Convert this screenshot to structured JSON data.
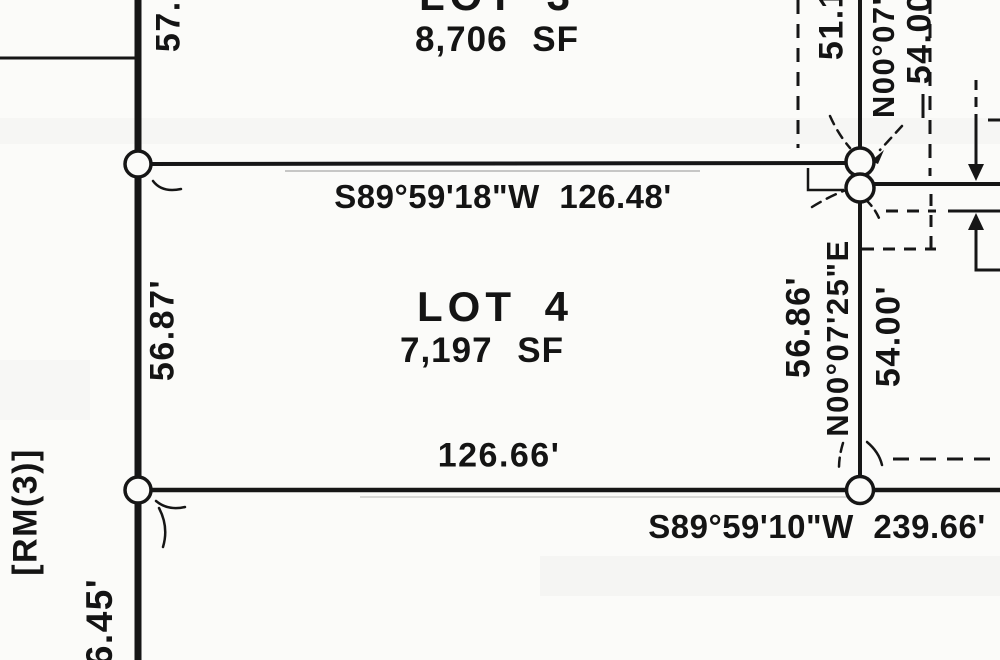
{
  "page": {
    "background": "#fbfbf9",
    "ink": "#141414"
  },
  "lots": {
    "lot3": {
      "name": "LOT 3",
      "area": "8,706 SF"
    },
    "lot4": {
      "name": "LOT 4",
      "area": "7,197 SF"
    }
  },
  "dimensions": {
    "north_bearing": "S89°59'18\"W 126.48'",
    "south_segment": "126.66'",
    "south_bearing": "S89°59'10\"W 239.66'",
    "west_top_partial": "57.0",
    "west_mid": "56.87'",
    "west_reference": "[RM(3)]",
    "west_bottom_partial": "6.45'",
    "east_top_dim_partial": "51.1",
    "east_top_bearing_partial": "N00°07'2",
    "east_top_len_partial": "54.00",
    "east_mid_dim": "56.86'",
    "east_mid_bearing": "N00°07'25\"E",
    "east_inner_len": "54.00'"
  }
}
